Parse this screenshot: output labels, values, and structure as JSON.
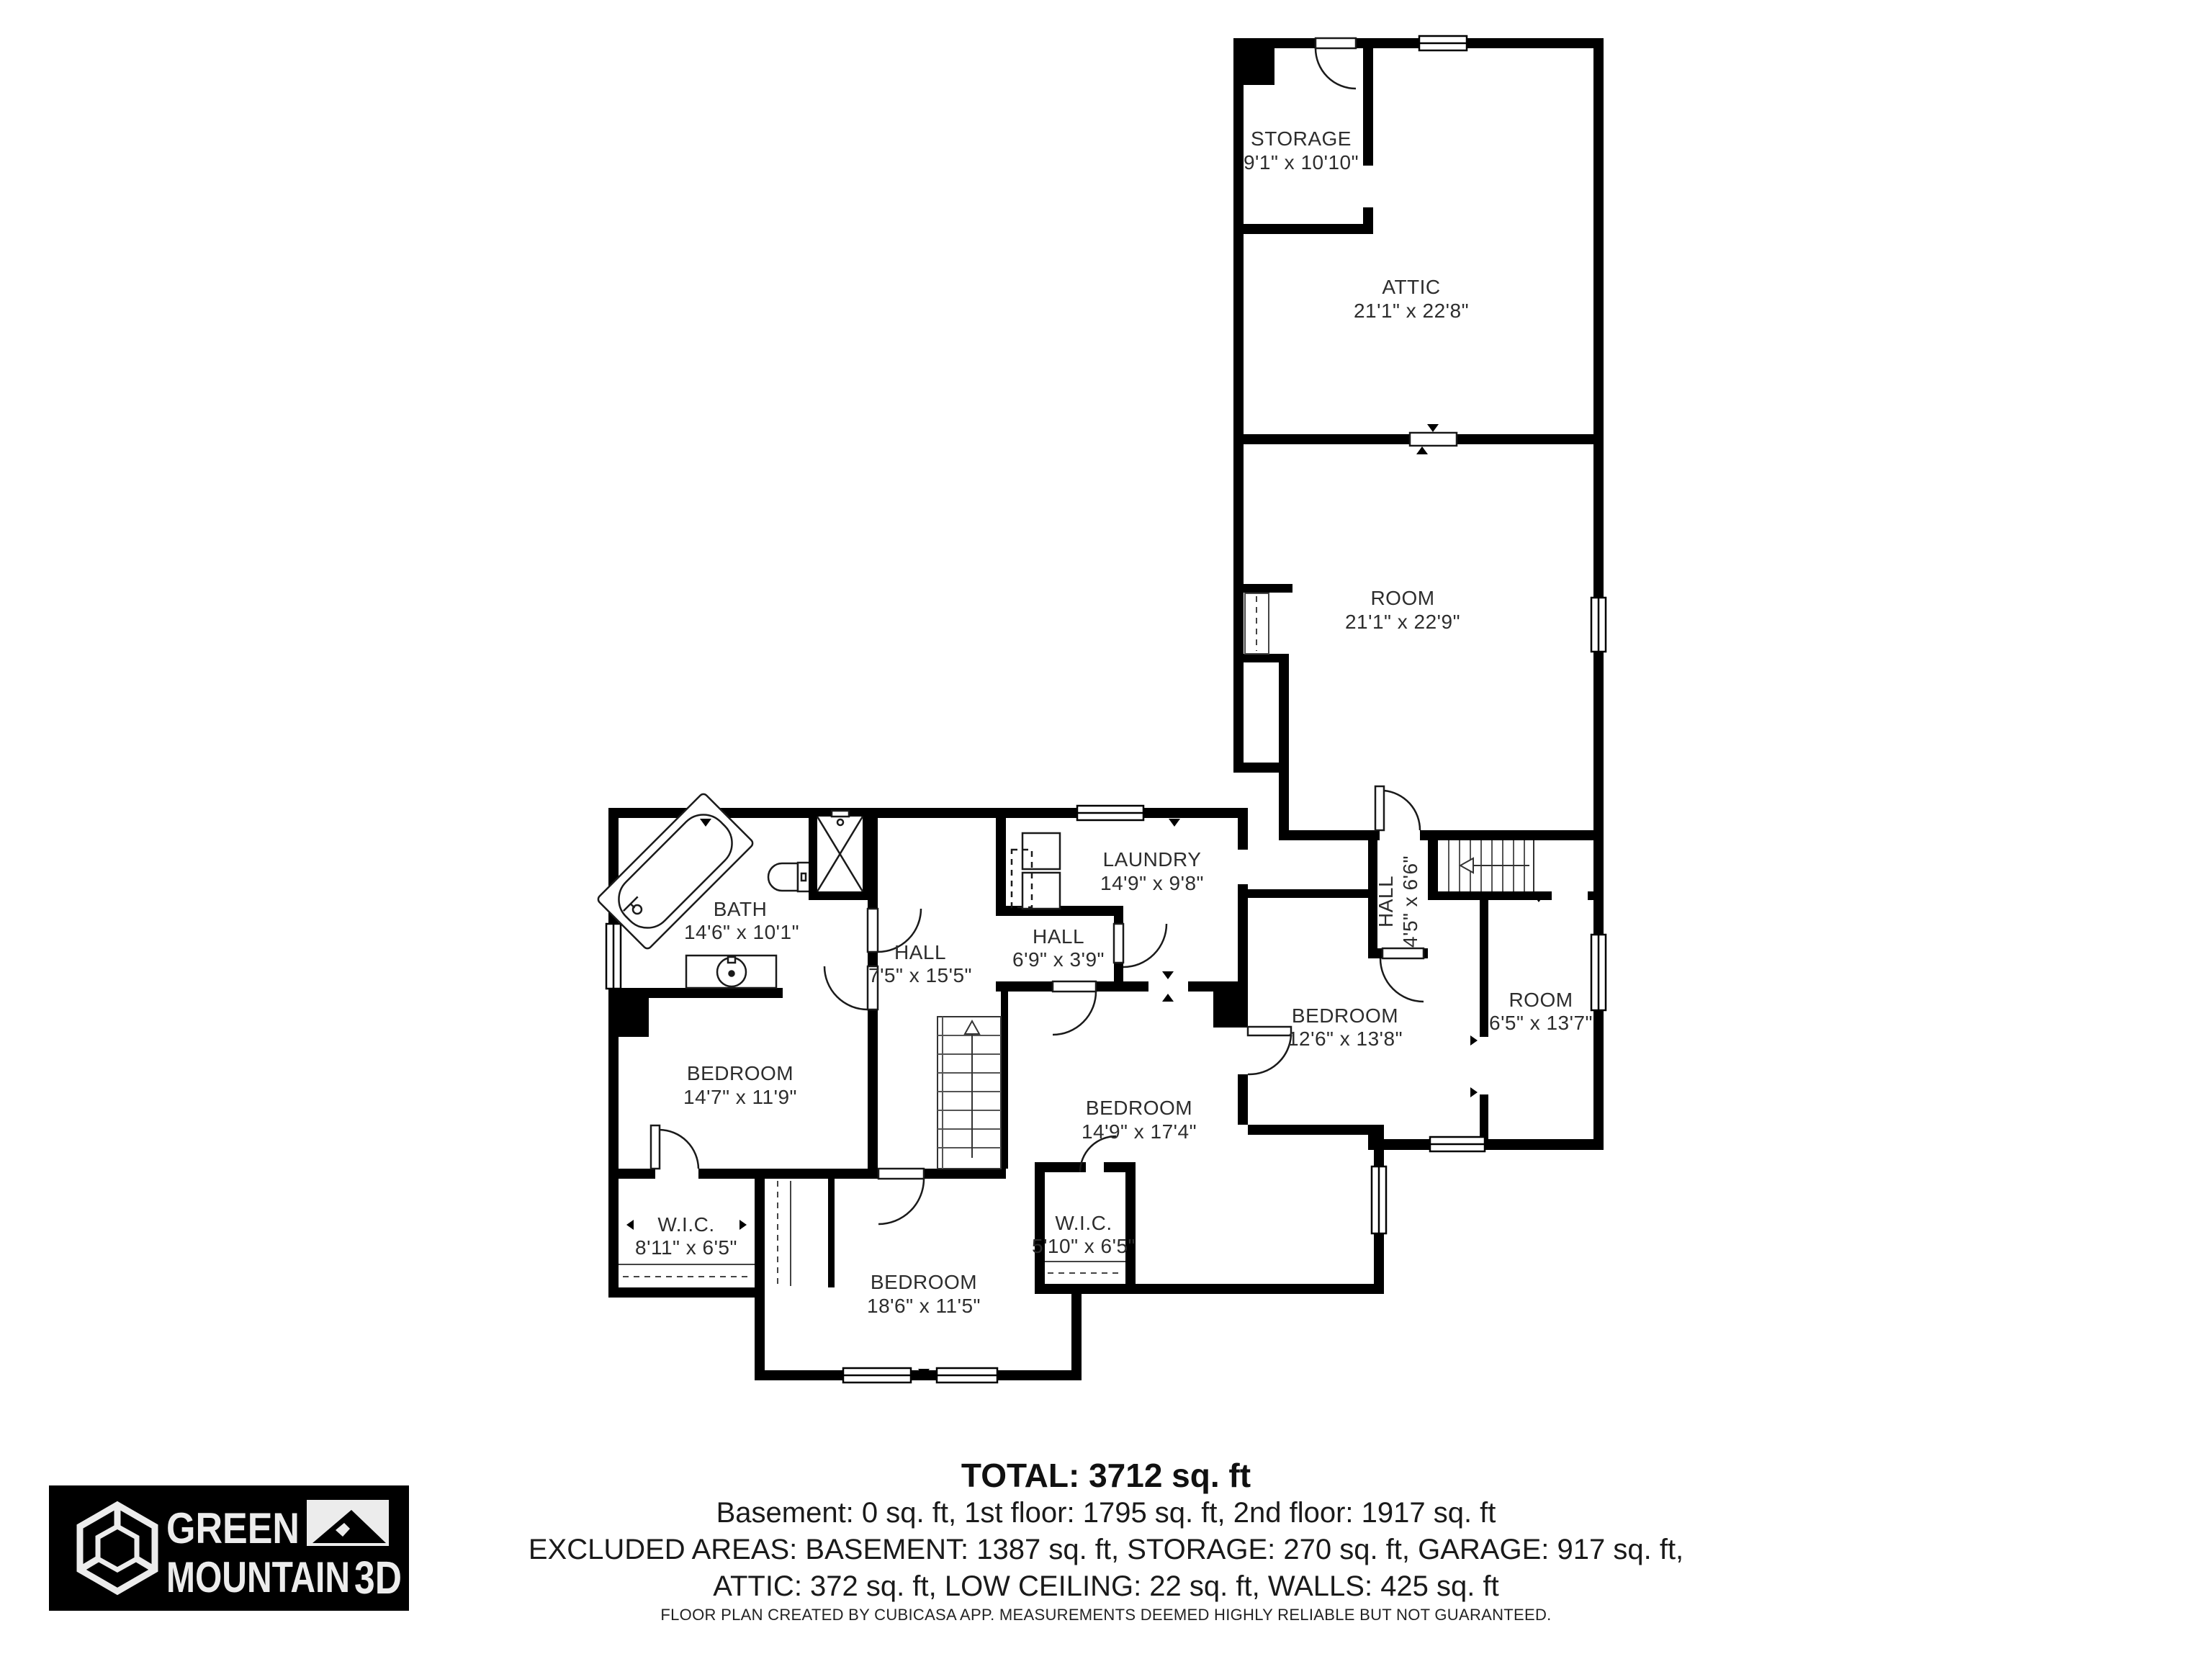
{
  "plan": {
    "rooms": [
      {
        "name": "STORAGE",
        "dims": "9'1\" x 10'10\""
      },
      {
        "name": "ATTIC",
        "dims": "21'1\" x 22'8\""
      },
      {
        "name": "ROOM",
        "dims": "21'1\" x 22'9\""
      },
      {
        "name": "LAUNDRY",
        "dims": "14'9\" x 9'8\""
      },
      {
        "name": "HALL",
        "dims": "6'9\" x 3'9\""
      },
      {
        "name": "BATH",
        "dims": "14'6\" x 10'1\""
      },
      {
        "name": "HALL",
        "dims": "7'5\" x 15'5\""
      },
      {
        "name": "BEDROOM",
        "dims": "14'7\" x 11'9\""
      },
      {
        "name": "HALL",
        "dims": "4'5\" x 6'6\""
      },
      {
        "name": "BEDROOM",
        "dims": "12'6\" x 13'8\""
      },
      {
        "name": "ROOM",
        "dims": "6'5\" x 13'7\""
      },
      {
        "name": "BEDROOM",
        "dims": "14'9\" x 17'4\""
      },
      {
        "name": "W.I.C.",
        "dims": "8'11\" x 6'5\""
      },
      {
        "name": "W.I.C.",
        "dims": "5'10\" x 6'5\""
      },
      {
        "name": "BEDROOM",
        "dims": "18'6\" x 11'5\""
      }
    ]
  },
  "footer": {
    "total": "TOTAL: 3712 sq. ft",
    "line1": "Basement: 0 sq. ft, 1st floor: 1795 sq. ft, 2nd floor: 1917 sq. ft",
    "line2": "EXCLUDED AREAS: BASEMENT: 1387 sq. ft, STORAGE: 270 sq. ft, GARAGE: 917 sq. ft,",
    "line3": "ATTIC: 372 sq. ft, LOW CEILING: 22 sq. ft, WALLS: 425 sq. ft",
    "disclaimer": "FLOOR PLAN CREATED BY CUBICASA APP. MEASUREMENTS DEEMED HIGHLY RELIABLE BUT NOT GUARANTEED."
  },
  "logo": {
    "word1": "GREEN",
    "word2": "MOUNTAIN",
    "suffix": "3D"
  },
  "colors": {
    "wall": "#000000",
    "label_text": "#2d2d2d",
    "logo_bg": "#000000",
    "logo_fg": "#ececec"
  }
}
